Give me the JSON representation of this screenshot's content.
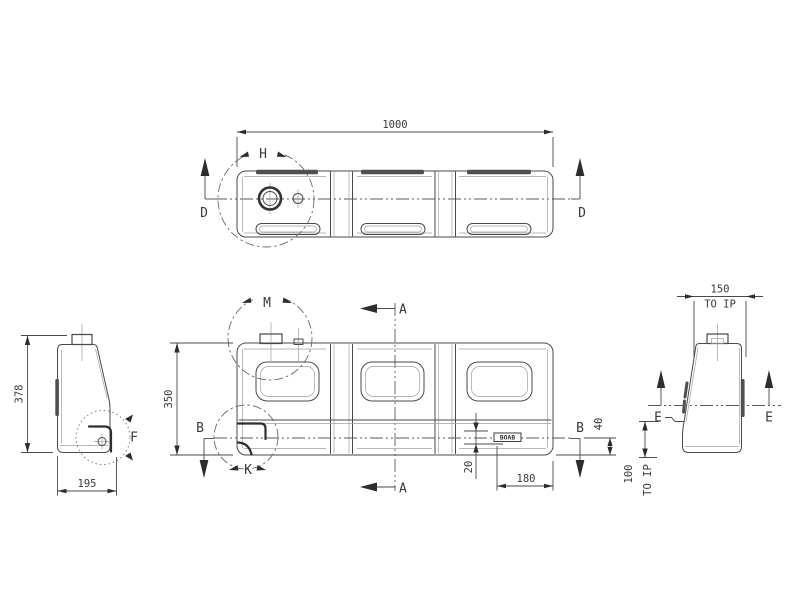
{
  "colors": {
    "background": "#ffffff",
    "line": "#4a4a4a",
    "text": "#3a3a3a",
    "fill_dark": "#4f4f4f"
  },
  "top": {
    "dim_length": "1000",
    "section_left": "D",
    "section_right": "D",
    "detail": "H"
  },
  "front": {
    "dim_height": "350",
    "detail_top": "M",
    "detail_corner": "K",
    "section_vertical_top": "A",
    "section_vertical_bottom": "A",
    "section_horizontal_left": "B",
    "section_horizontal_right": "B",
    "logo": "BOAB",
    "dim_logo_drop": "20",
    "dim_logo_inset": "180",
    "dim_base_offset": "40"
  },
  "left": {
    "dim_height": "378",
    "dim_width": "195",
    "detail": "F"
  },
  "right": {
    "dim_width": "150",
    "dim_width_note": "TO IP",
    "dim_height": "100",
    "dim_height_note": "TO IP",
    "section_left": "E",
    "section_right": "E"
  }
}
